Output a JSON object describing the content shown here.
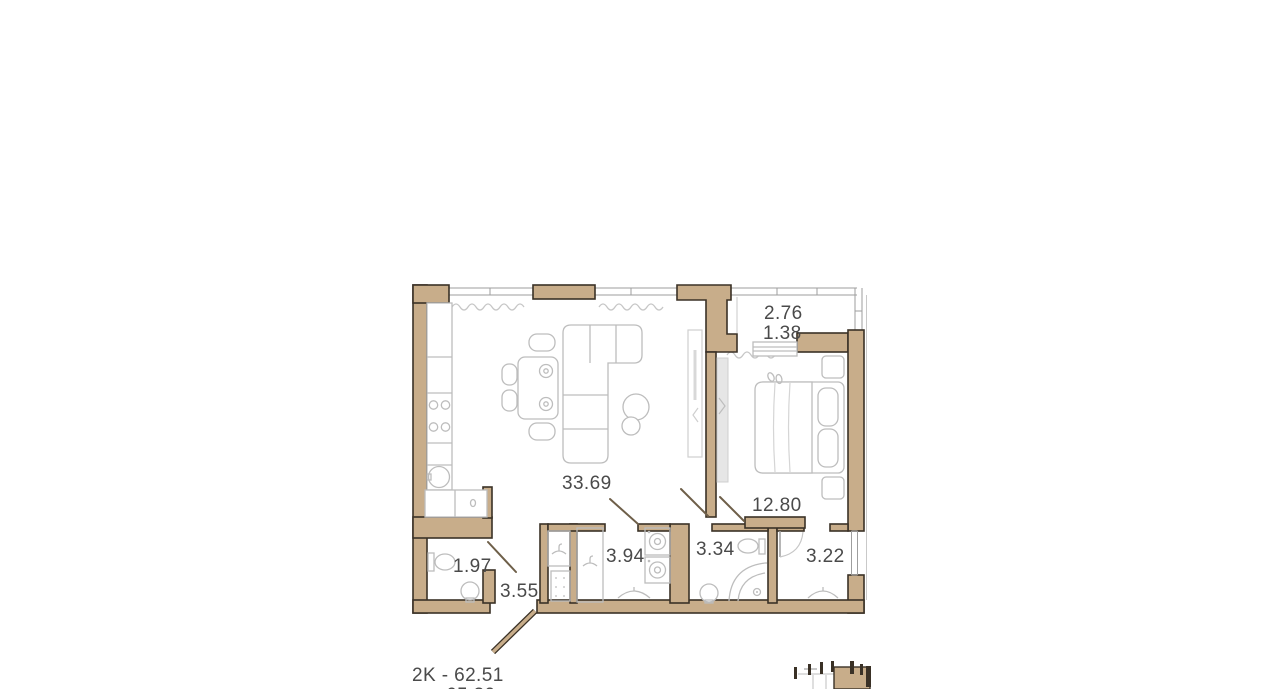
{
  "apartment": {
    "type_area_label": "2K - 62.51",
    "secondary_area_label": "65.39",
    "rooms": {
      "living_kitchen": "33.69",
      "bedroom": "12.80",
      "balcony_full": "2.76",
      "balcony_reduced": "1.38",
      "hall": "3.55",
      "corridor": "3.94",
      "bathroom": "3.34",
      "dressing": "3.22",
      "wc": "1.97"
    }
  },
  "colors": {
    "wall_fill": "#C8AD8A",
    "wall_outline": "#3A3126",
    "furniture_line": "#BDBDBD",
    "window_line": "#9E9E9E",
    "door_line": "#6E5F49",
    "label_text": "#4A4A4A",
    "background": "#FFFFFF"
  },
  "furniture_icons": [
    "kitchen-counter",
    "stove-burners",
    "kitchen-sink",
    "dining-table",
    "chairs",
    "corner-sofa",
    "coffee-tables",
    "tv-console",
    "sliding-wardrobe",
    "double-bed",
    "pillows",
    "blanket",
    "nightstands",
    "slippers",
    "balcony-bench",
    "washer",
    "dryer",
    "coat-hook",
    "shoe-rack",
    "hanger",
    "toilet",
    "wash-basin",
    "corner-shower",
    "building-locator-minimap"
  ]
}
